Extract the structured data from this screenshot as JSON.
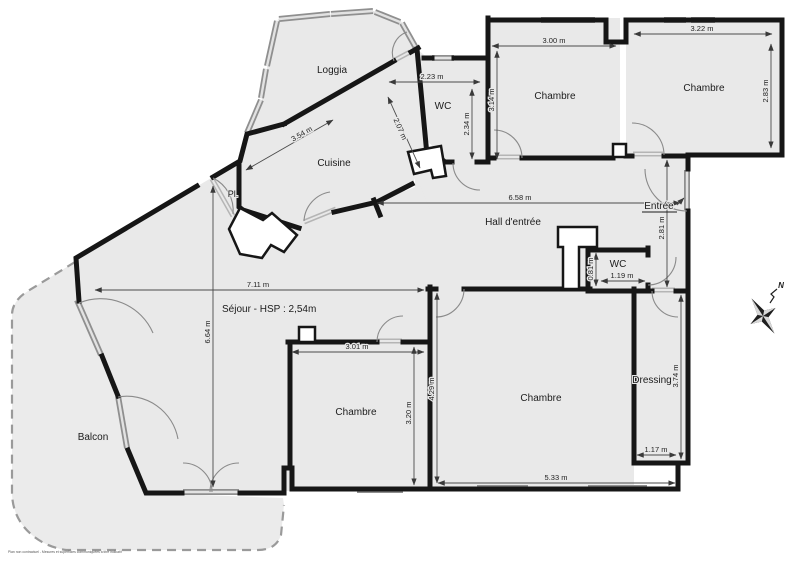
{
  "labels": {
    "loggia": "Loggia",
    "cuisine": "Cuisine",
    "placard": "Pl.",
    "wc_top": "WC",
    "chambre_top_middle": "Chambre",
    "chambre_top_right": "Chambre",
    "hall": "Hall d'entrée",
    "entree": "Entrée",
    "wc_hall": "WC",
    "sejour": "Séjour - HSP : 2,54m",
    "balcon": "Balcon",
    "chambre_bottom_left": "Chambre",
    "chambre_bottom_right": "Chambre",
    "dressing": "Dressing",
    "north": "N",
    "fine_print": "Plan non contractuel - Mesures et superficies communiquées à titre indicatif"
  },
  "dimensions": {
    "wc_top_width": "2.23 m",
    "wc_top_height": "2.34 m",
    "chambre_tm_width": "3.00 m",
    "chambre_tm_height": "3.14 m",
    "chambre_tr_width": "3.22 m",
    "chambre_tr_height": "2.83 m",
    "cuisine_length": "3.54 m",
    "cuisine_width": "2.07 m",
    "hall_length": "6.58 m",
    "entree_height": "2.81 m",
    "wc_hall_height": "0.81 m",
    "wc_hall_width": "1.19 m",
    "sejour_width": "7.11 m",
    "sejour_height": "6.64 m",
    "chambre_bl_width": "3.01 m",
    "chambre_bl_height": "3.20 m",
    "chambre_br_height": "4.29 m",
    "chambre_br_width": "5.33 m",
    "dressing_width": "1.17 m",
    "dressing_height": "3.74 m"
  },
  "colors": {
    "room_fill": "#e9e9e9",
    "wall": "#161616",
    "balcony_dash": "#9a9a9a"
  }
}
